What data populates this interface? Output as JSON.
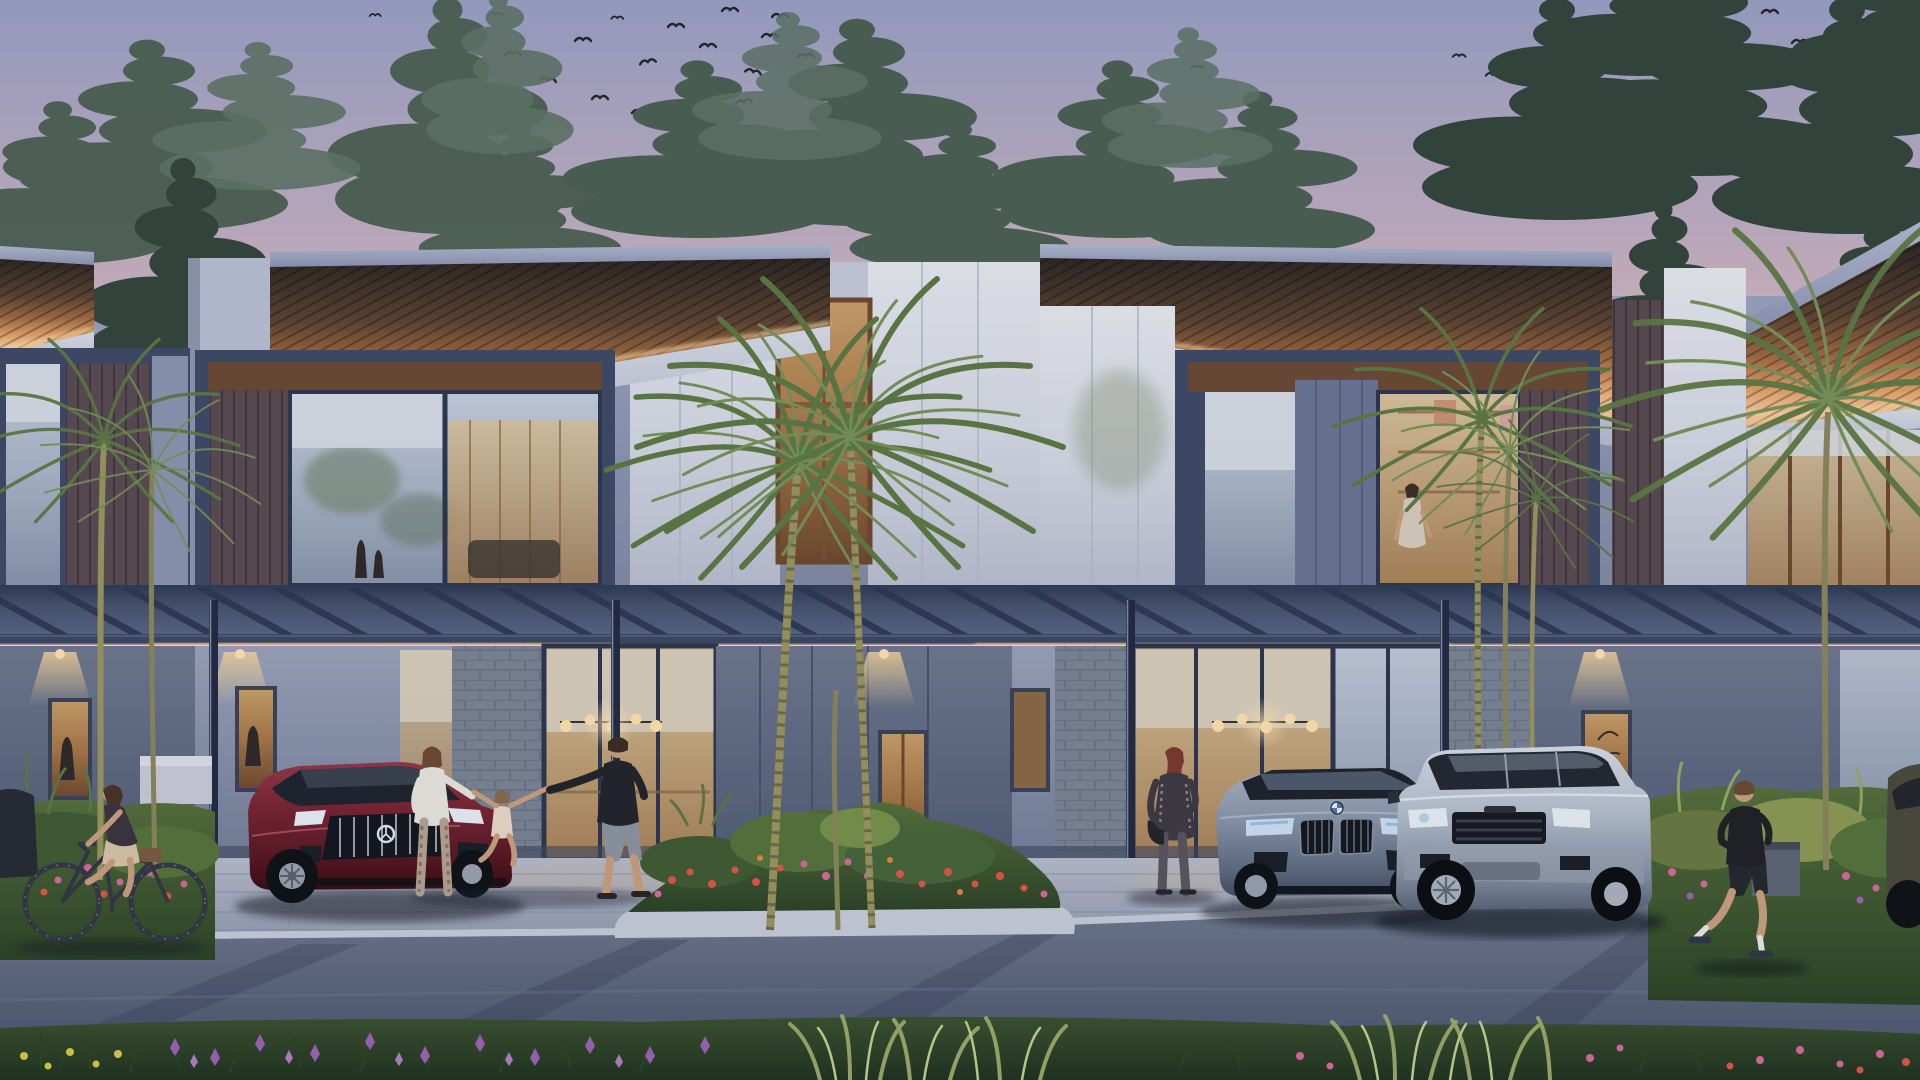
{
  "meta": {
    "title": "Modern two-storey townhouse row at dusk — photorealistic architectural rendering",
    "image_type": "architectural exterior rendering, no visible text or UI",
    "time_of_day": "dusk"
  },
  "palette": {
    "sky_top": "#9aa0c5",
    "sky_mid": "#c9b2c2",
    "sky_horizon": "#f2d8c3",
    "sky_glow": "#f8e7d0",
    "roof_fascia": "#a3abc6",
    "soffit_glow": "#f6cf9c",
    "led_strip": "#ffd9a2",
    "upper_wall": "#8f99b6",
    "stone_white": "#dfe2ea",
    "frame_dark": "#3e4a68",
    "wood_panel": "#5a4b52",
    "glass_cool": "#aab6ca",
    "glass_warm": "#c9a06a",
    "cladding_gray": "#78808f",
    "paving": "#a9b1c3",
    "road": "#5b6478",
    "curb": "#c6ccd9",
    "grass_dark": "#2e4629",
    "shrub_green": "#46663a",
    "flower_red": "#e05548",
    "flower_pink": "#d76a9e",
    "flower_purple": "#9c63b5",
    "flower_yellow": "#d8c84e",
    "car_maroon": "#6e1f2d",
    "car_bmw_grey": "#8e9cb2",
    "car_suv_silver": "#c3cedc",
    "pine_dark": "#33463d",
    "pine_mid": "#4b6053",
    "pine_light": "#5f7568",
    "palm_green": "#5d7a45",
    "palm_light": "#79935a",
    "palm_trunk": "#9a9660",
    "bird": "#23262c",
    "skin": "#c9a07e",
    "shirt_dark": "#22252b"
  },
  "scene": {
    "sky": "Clear dusk sky fading from lavender-blue to peach at the horizon, flocks of birds upper centre and upper right",
    "architecture": "Row of modern two-storey townhouses with cantilevered roofs, warm LED-lit slatted soffits, dark-framed upper window boxes, white stone cores, carport pergolas and glazed ground floors",
    "vehicles": [
      {
        "name": "maroon sports sedan with chrome grille and three-pointed-star badge",
        "color": "#6e1f2d",
        "position": "left carport"
      },
      {
        "name": "grey-blue coupe sedan with twin kidney grille and roundel badge",
        "color": "#8e9cb2",
        "position": "right carport"
      },
      {
        "name": "silver compact luxury SUV with slatted grille",
        "color": "#c3cedc",
        "position": "right carport, nearer"
      },
      {
        "name": "partially visible parked car",
        "color": "#4a4a3c",
        "position": "far right edge"
      }
    ],
    "people": [
      "woman riding a bicycle on the left",
      "mother, father and small child being swung by the hands in front of the left house",
      "woman walking toward the grey-blue sedan",
      "man jogging on the right",
      "woman standing at an upstairs window of the right house"
    ],
    "vegetation": "Pine trees behind the roofline, slender palms, tropical shrubs, red and orange flower island, purple and pink flower beds in the foreground",
    "lighting": "Warm LED strips under roof soffits and floor slabs, pendant globe chandeliers inside, wall downlights",
    "street": "Paved driveway aprons, kerbed planting island, asphalt street with long tree shadows, grass verge in the foreground"
  }
}
